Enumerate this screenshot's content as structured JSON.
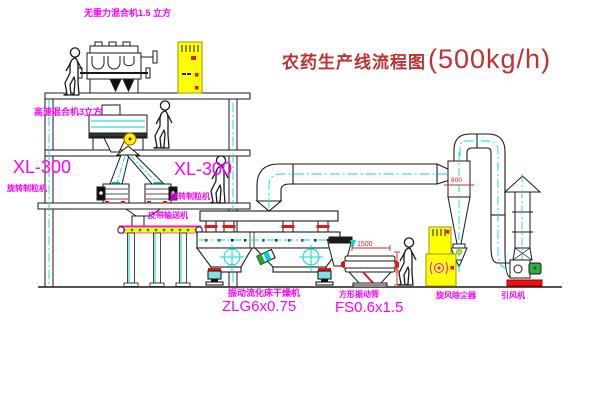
{
  "title": {
    "text": "农药生产线流程图",
    "capacity": "(500kg/h)"
  },
  "equipment_labels": {
    "gravity_free_mixer": "无重力混合机1.5 立方",
    "high_speed_mixer": "高速混合机3立方",
    "granulator_left": {
      "model": "XL-300",
      "name": "旋转制粒机"
    },
    "granulator_center": {
      "model": "XL-300",
      "name": "旋转制粒机"
    },
    "belt_conveyor": "皮带输送机",
    "fluid_bed_dryer": {
      "name": "振动流化床干燥机",
      "model": "ZLG6x0.75"
    },
    "square_sieve": {
      "name": "方形振动筛",
      "model": "FS0.6x1.5"
    },
    "cyclone": "旋风除尘器",
    "fan": "引风机"
  },
  "dimensions": {
    "sieve_length": "1500",
    "sieve_height": "900",
    "cyclone_mark": "800"
  },
  "colors": {
    "label_magenta": "#ff00ff",
    "title_red": "#c23030",
    "line_black": "#1a1a1a",
    "centerline_cyan": "#00dddd",
    "cabinet_yellow": "#ffff00",
    "accent_red": "#ee1111",
    "conveyor_dot_green": "#009900",
    "motor_green": "#33aa44"
  }
}
